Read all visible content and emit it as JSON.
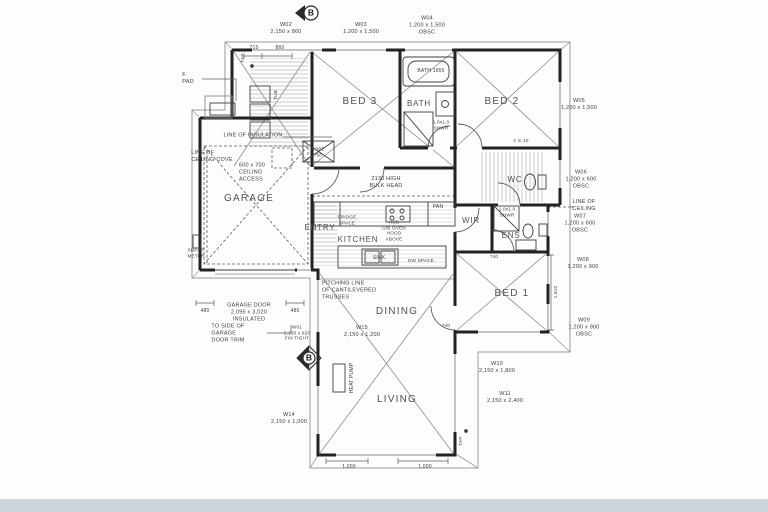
{
  "colors": {
    "paper": "#fdfdfd",
    "ink": "#3d3d3d",
    "wall": "#222222",
    "bottom_bar": "#cdd4da"
  },
  "markers": {
    "section_top": "B",
    "section_side": "B"
  },
  "rooms": {
    "garage": "GARAGE",
    "bed3": "BED 3",
    "bath": "BATH",
    "bed2": "BED 2",
    "wc": "WC",
    "wir": "WIR",
    "ens": "ENS",
    "bed1": "BED 1",
    "entry": "ENTRY",
    "kitchen": "KITCHEN",
    "dining": "DINING",
    "living": "LIVING"
  },
  "windows": {
    "w01": "W01\n2,150 x 920\nFIN TIGHT",
    "w02": "W02\n2,150 x 860",
    "w03": "W03\n1,200 x 1,500",
    "w04": "W04\n1,200 x 1,500\nOBSC",
    "w05": "W05\n1,200 x 1,500",
    "w06": "W06\n1,200 x 600\nOBSC",
    "w07": "W07\n1,200 x 600\nOBSC",
    "w08": "W08\n1,200 x 900",
    "w09": "W09\n1,200 x 900\nOBSC",
    "w10": "W10\n2,150 x 1,800",
    "w11": "W11\n2,150 x 2,400",
    "w14": "W14\n2,150 x 1,000",
    "w15": "W15\n2,150 x 1,200"
  },
  "notes": {
    "insulation": "LINE OF INSULATION",
    "ceiling_cove": "LINE OF\nCEILING COVE",
    "ceiling_access": "600 x 700\nCEILING\nACCESS",
    "bulkhead": "2130 HIGH\nBULK HEAD",
    "pitching": "PITCHING LINE\nOF CANTILEVERED\nTRUSSES",
    "garage_door": "GARAGE DOOR\n2,095 x 3,020\nINSULATED",
    "door_trim": "TO SIDE OF\nGARAGE\nDOOR TRIM",
    "line_ceiling": "LINE OF\nCEILING"
  },
  "fixtures": {
    "bath_tub": "BATH 1655",
    "shwr_bath": "1.0x1.0\nSHWR",
    "shwr_ens": "1.0x1.0\nSHWR",
    "pan": "PAN",
    "sink": "SINK",
    "dw": "DW SPACE",
    "fridge": "FRIDGE\nSPACE",
    "hob": "HOB\nU/B OVEN\nHOOD\nABOVE",
    "robe": "ROBE\n750",
    "tub": "TUB",
    "heat_pump": "HEAT PUMP",
    "smart_meter": "SMART\nMETER",
    "f_pad": "F\nPAD",
    "tap1": "TAP",
    "tap2": "TAP"
  },
  "dims": {
    "d715": "715",
    "d860": "860",
    "d480a": "480",
    "d480b": "480",
    "d1000a": "1,000",
    "d1000b": "1,000",
    "d1810": "1,810",
    "d740a": "740",
    "d740b": "740",
    "fall": "2 in 10"
  }
}
